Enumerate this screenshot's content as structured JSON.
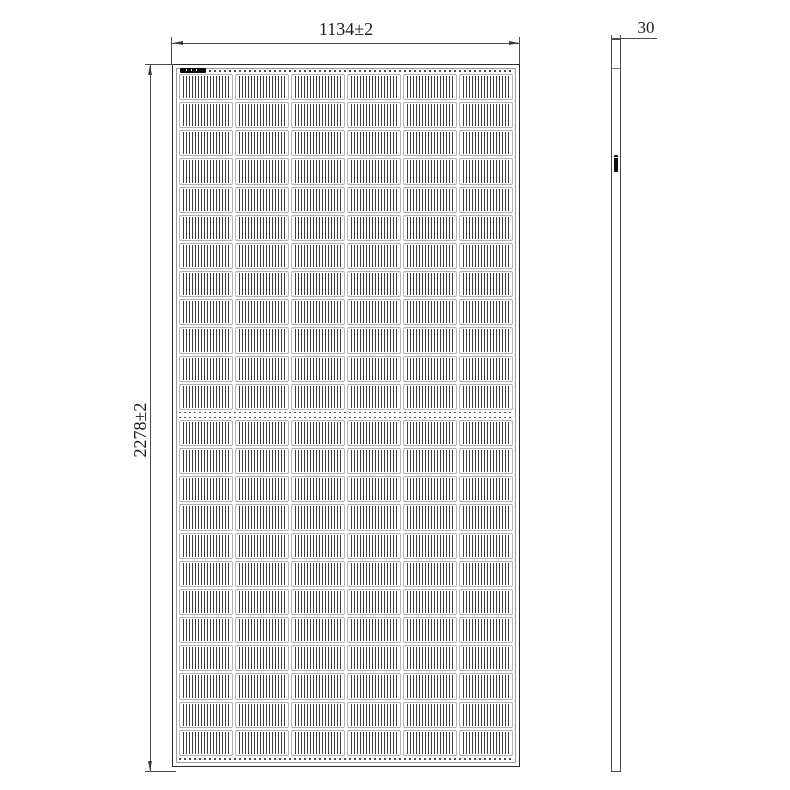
{
  "drawing": {
    "type": "technical-dimension-drawing",
    "subject": "solar panel module, front view and side profile",
    "front_view": {
      "width_dim_label": "1134±2",
      "height_dim_label": "2278±2",
      "cell_grid": {
        "columns": 6,
        "rows_top_half": 12,
        "rows_bottom_half": 12,
        "total_cells": 144
      }
    },
    "side_view": {
      "thickness_dim_label": "30"
    },
    "colors": {
      "background": "#ffffff",
      "line": "#4a4a4a",
      "cell_stripe": "#3c3c3c",
      "inner_frame": "#9a9a9a",
      "label_black": "#0d0d0d"
    }
  }
}
